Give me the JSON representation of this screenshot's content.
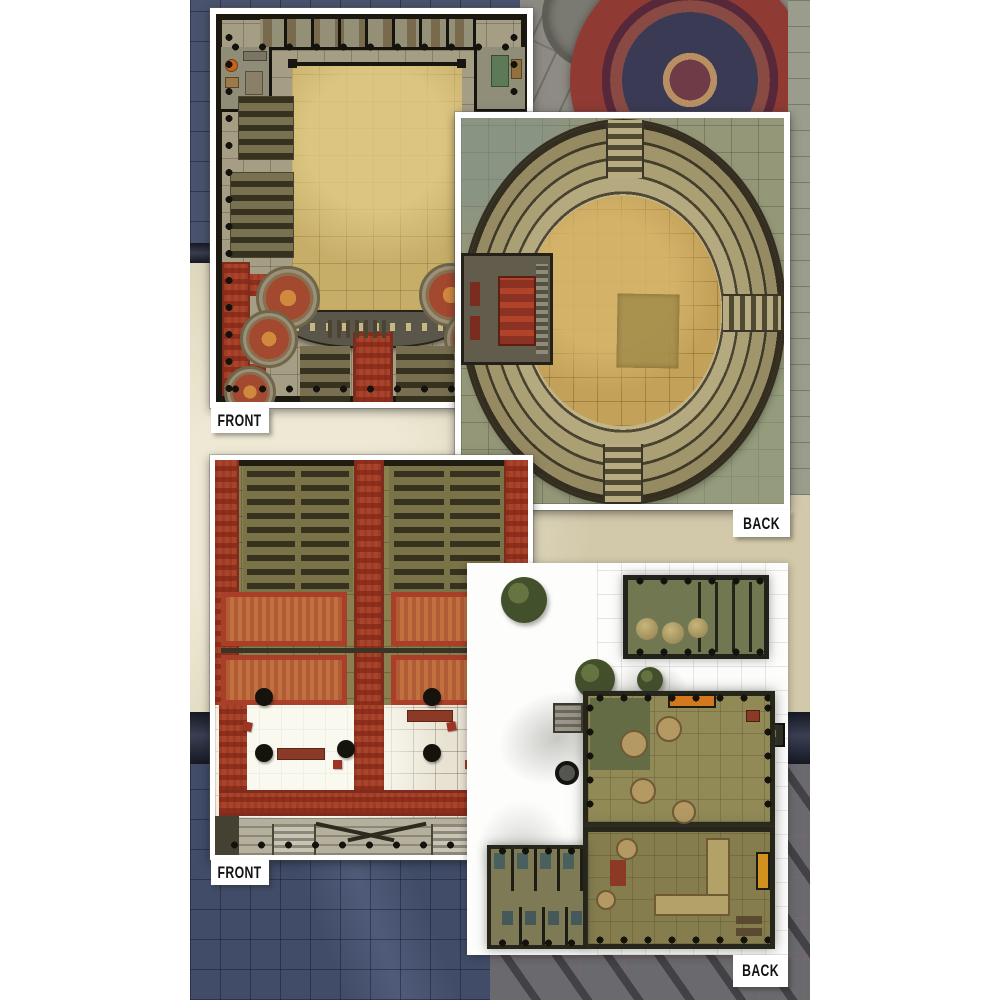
{
  "panels": [
    {
      "name": "temple-hall-map",
      "position": "top-left",
      "side_label": "FRONT"
    },
    {
      "name": "arena-map",
      "position": "top-right",
      "side_label": "BACK"
    },
    {
      "name": "temple-sanctum-map",
      "position": "bottom-left",
      "side_label": "FRONT"
    },
    {
      "name": "inn-courtyard-map",
      "position": "bottom-right",
      "side_label": "BACK"
    }
  ],
  "labels_meaning": "FRONT and BACK indicate the two printed sides of each double-sided battle mat",
  "colors": {
    "page_margin": "#ffffff",
    "backdrop_navy": "#46536e",
    "backdrop_parchment": "#ddd5ba",
    "backdrop_stone_gray": "#8d8b84",
    "backdrop_rug_red": "#8f3b33",
    "backdrop_street_gray": "#6a6a6e",
    "map_courtyard_tan": "#c4ac67",
    "arena_field_tan": "#c3a159",
    "arena_ring_stone": "#c9bd93",
    "carpet_red": "#a8432c",
    "terrace_orange": "#c0713f",
    "tavern_green": "#707751",
    "label_background": "#ffffff",
    "label_text": "#131313"
  }
}
